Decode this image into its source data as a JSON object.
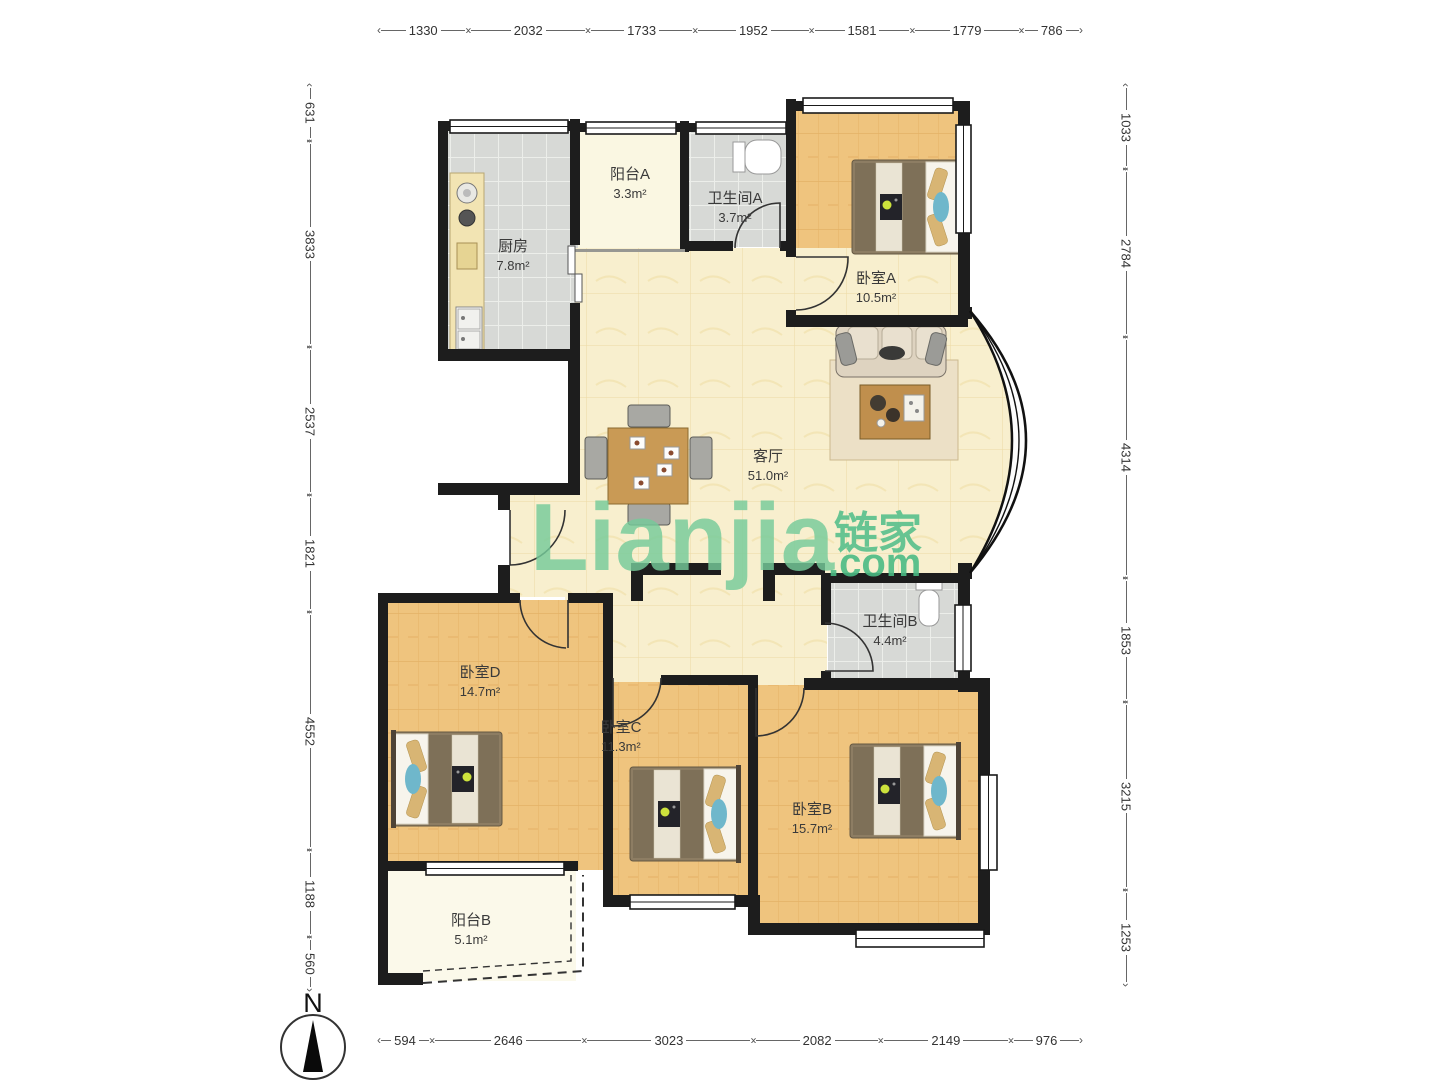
{
  "watermark": {
    "latin": "Lianjia",
    "cjk": "链家",
    "domain": ".com"
  },
  "compass": {
    "label": "N"
  },
  "dimensions": {
    "top": [
      "1330",
      "2032",
      "1733",
      "1952",
      "1581",
      "1779",
      "786"
    ],
    "bottom": [
      "594",
      "2646",
      "3023",
      "2082",
      "2149",
      "976"
    ],
    "left": [
      "631",
      "3833",
      "2537",
      "1821",
      "4552",
      "1188",
      "560"
    ],
    "right": [
      "1033",
      "2784",
      "4314",
      "1853",
      "3215",
      "1253"
    ]
  },
  "rooms": {
    "kitchen": {
      "name": "厨房",
      "area": "7.8m²"
    },
    "balcony_a": {
      "name": "阳台A",
      "area": "3.3m²"
    },
    "bath_a": {
      "name": "卫生间A",
      "area": "3.7m²"
    },
    "bed_a": {
      "name": "卧室A",
      "area": "10.5m²"
    },
    "living": {
      "name": "客厅",
      "area": "51.0m²"
    },
    "bath_b": {
      "name": "卫生间B",
      "area": "4.4m²"
    },
    "bed_d": {
      "name": "卧室D",
      "area": "14.7m²"
    },
    "bed_c": {
      "name": "卧室C",
      "area": "11.3m²"
    },
    "bed_b": {
      "name": "卧室B",
      "area": "15.7m²"
    },
    "balcony_b": {
      "name": "阳台B",
      "area": "5.1m²"
    }
  },
  "colors": {
    "wall": "#1d1d1d",
    "wood_floor": "#efc47e",
    "living_floor": "#f8efce",
    "tile_floor": "#d7d9d6",
    "balcony_floor": "#faf7e2",
    "watermark_green": "#5fc08e"
  }
}
